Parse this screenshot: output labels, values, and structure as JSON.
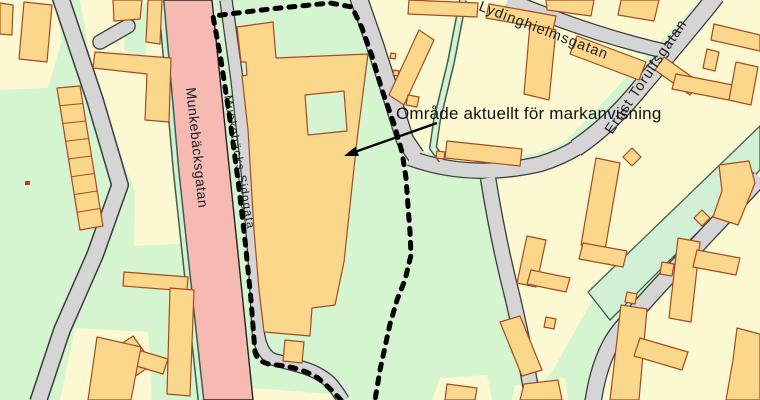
{
  "map": {
    "annotation": {
      "label": "Område aktuellt för markanvisning"
    },
    "streets": {
      "munkebacksgatan": {
        "label": "Munkebäcksgatan"
      },
      "munkebacks_sidogata": {
        "label": "Munkebäcks Sidogata"
      },
      "lydinghielmsgatan": {
        "label": "Lydinghielmsgatan"
      },
      "ernst_torulfsgatan": {
        "label": "Ernst Torulfsgatan"
      }
    },
    "colors": {
      "park_green": "#D5F4D0",
      "block_yellow": "#FBF8D2",
      "building_fill": "#FBD78B",
      "building_stroke": "#A84A20",
      "road_fill": "#D5D5D5",
      "road_casing": "#3C3C3C",
      "main_road_pink": "#F6B9B4",
      "footpath_green": "#D2F0D6",
      "boundary_dash": "#000000",
      "label_color": "#111111"
    }
  }
}
